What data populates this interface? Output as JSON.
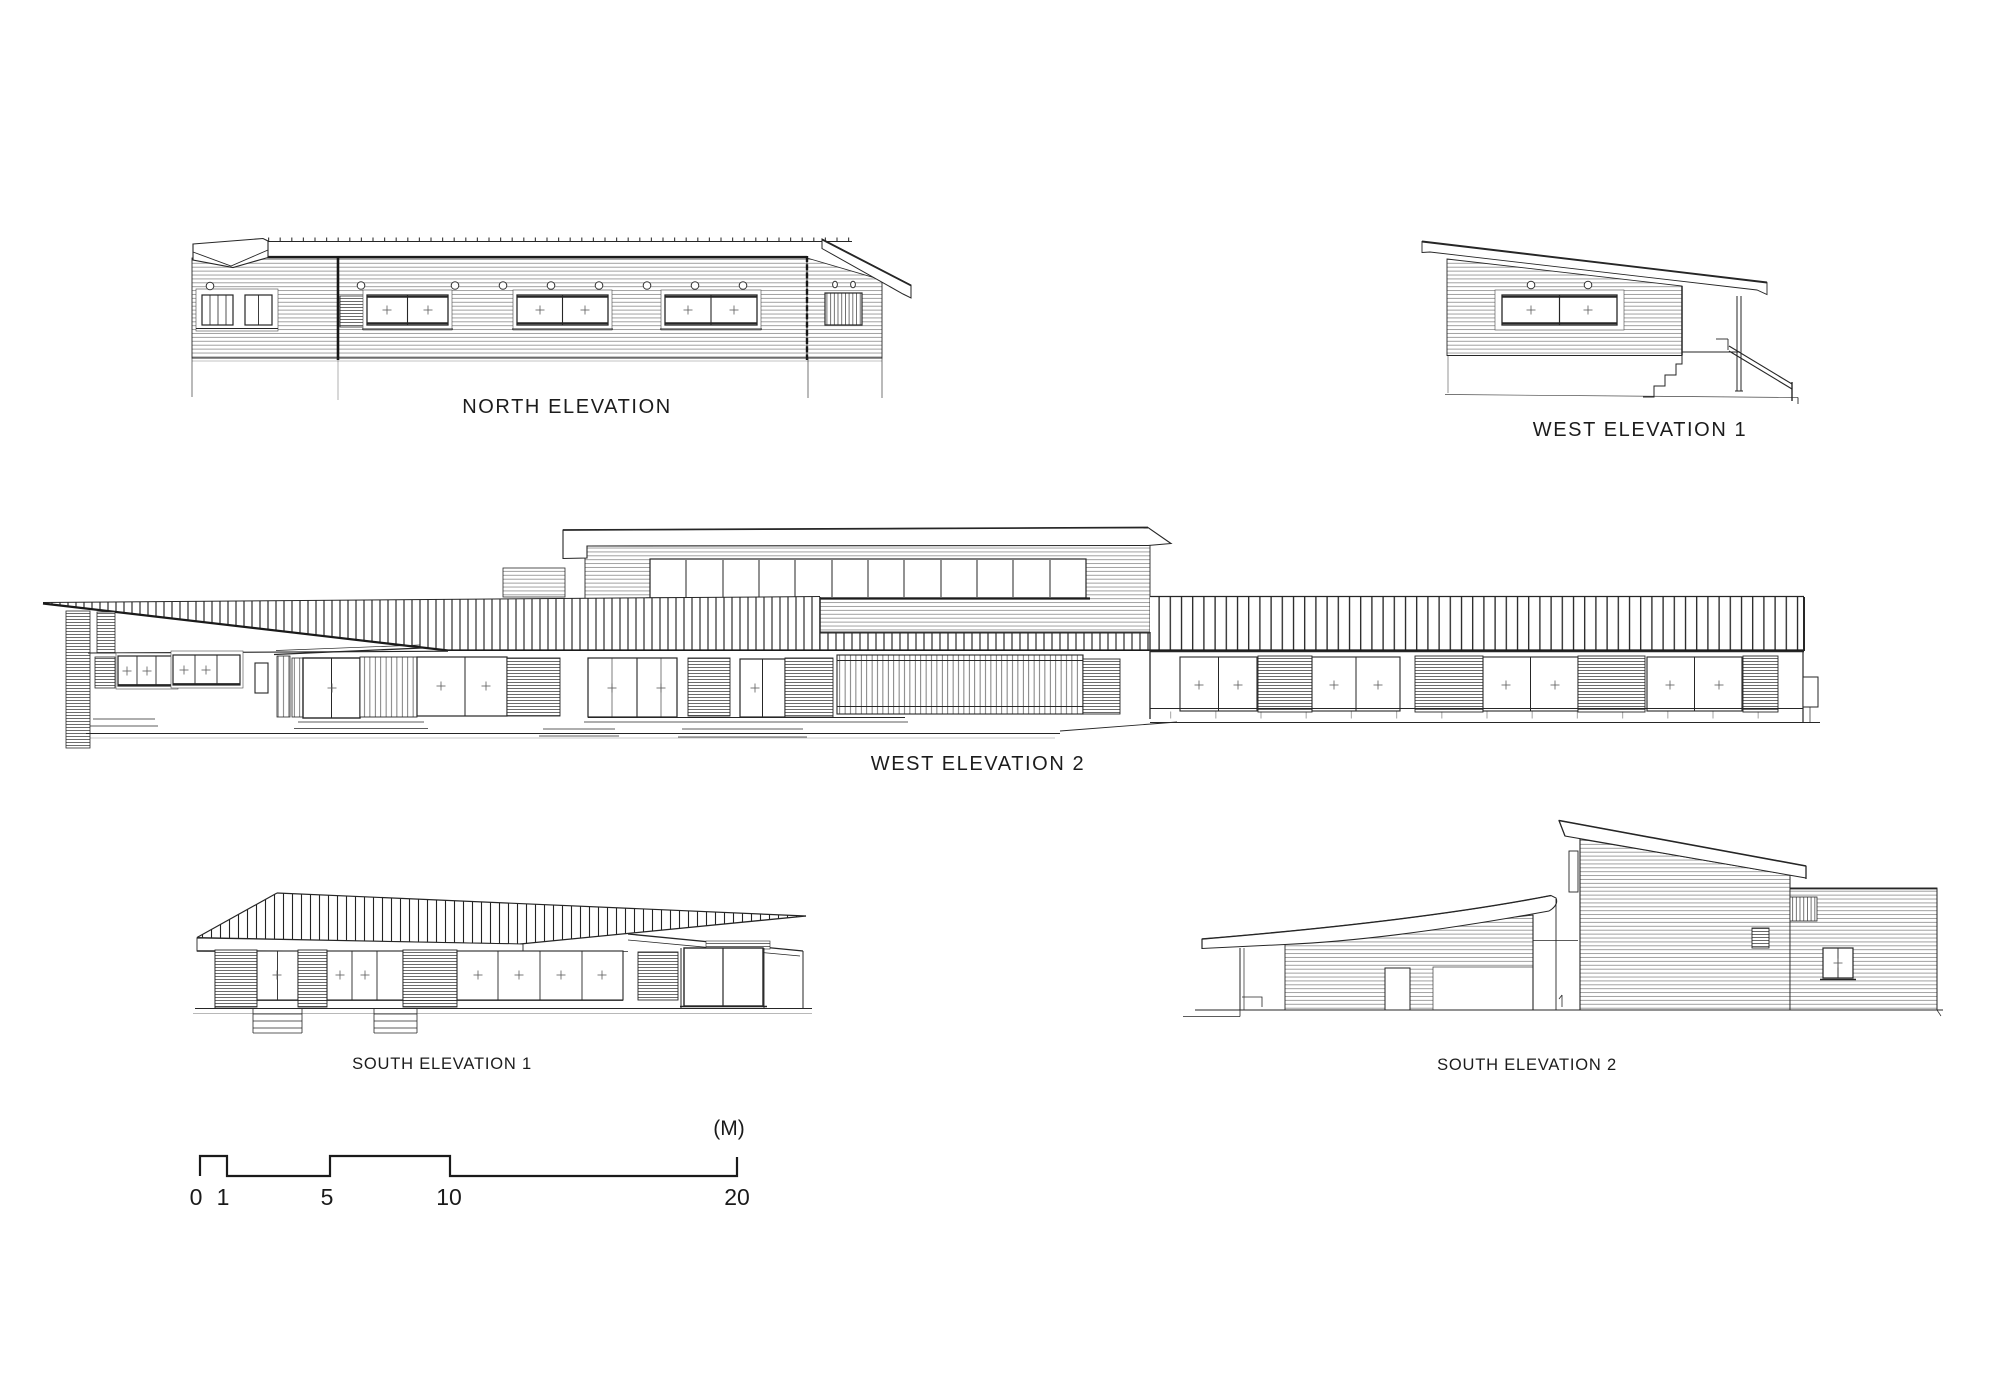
{
  "sheet": {
    "background": "#ffffff",
    "ink_color": "#262626",
    "content": "architectural elevation drawings"
  },
  "elevations": {
    "north": {
      "label": "NORTH ELEVATION"
    },
    "west1": {
      "label": "WEST ELEVATION 1"
    },
    "west2": {
      "label": "WEST ELEVATION 2"
    },
    "south1": {
      "label": "SOUTH ELEVATION 1"
    },
    "south2": {
      "label": "SOUTH ELEVATION 2"
    }
  },
  "scale_bar": {
    "unit_label": "(M)",
    "ticks": [
      "0",
      "1",
      "5",
      "10",
      "20"
    ],
    "meters": [
      0,
      1,
      5,
      10,
      20
    ]
  }
}
